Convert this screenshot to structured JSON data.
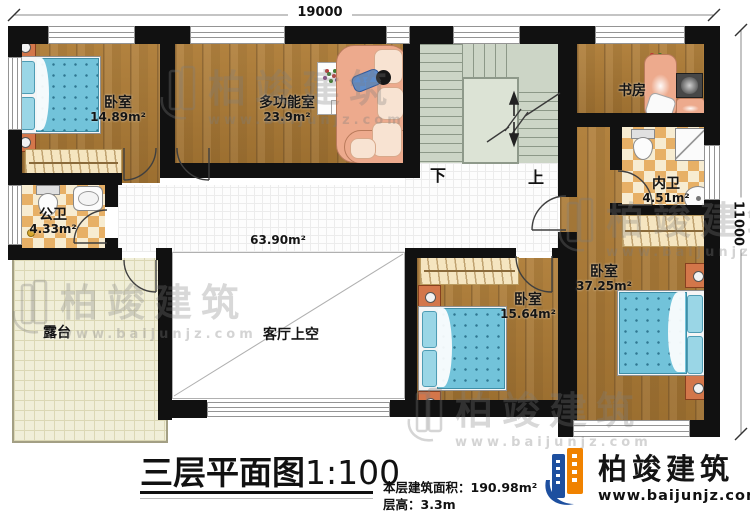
{
  "plan": {
    "dimensions": {
      "top": "19000",
      "right": "11000"
    },
    "rooms": {
      "bedroom_left": {
        "name": "卧室",
        "area": "14.89m²"
      },
      "multi_room": {
        "name": "多功能室",
        "area": "23.9m²"
      },
      "study": {
        "name": "书房"
      },
      "inner_bath": {
        "name": "内卫",
        "area": "4.51m²"
      },
      "public_bath": {
        "name": "公卫",
        "area": "4.33m²"
      },
      "terrace": {
        "name": "露台"
      },
      "living_void": {
        "name": "客厅上空"
      },
      "corridor": {
        "area": "63.90m²"
      },
      "bedroom_mid": {
        "name": "卧室",
        "area": "15.64m²"
      },
      "bedroom_right": {
        "name": "卧室",
        "area": "37.25m²"
      }
    },
    "stairs": {
      "down_label": "下",
      "up_label": "上"
    }
  },
  "titleblock": {
    "title": "三层平面图",
    "scale": "1:100",
    "area_info": "本层建筑面积：190.98m²",
    "floor_height": "层高：3.3m"
  },
  "logo": {
    "company": "柏竣建筑",
    "website": "www.baijunjz.com"
  },
  "watermark": {
    "text": "柏竣建筑",
    "url": "www.baijunjz.com"
  },
  "colors": {
    "logo_blue": "#1d4f9f",
    "logo_orange": "#f08200",
    "wall": "#111111",
    "bed": "#72c3da",
    "tile": "#e6af62",
    "stairs": "#ccd5c6",
    "wood": "#a87838"
  }
}
